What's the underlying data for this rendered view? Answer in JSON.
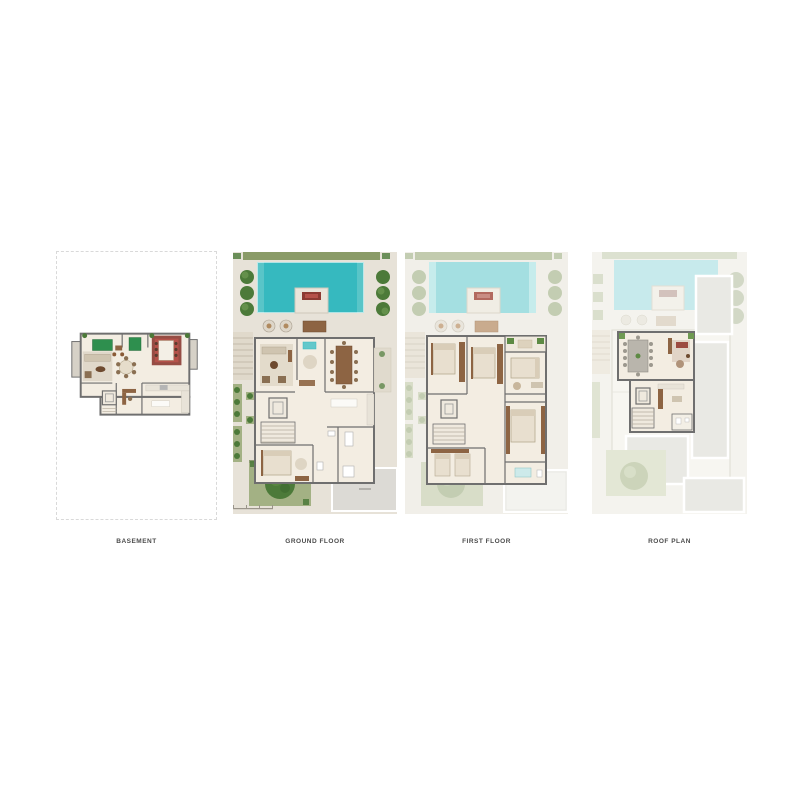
{
  "page": {
    "background": "#ffffff"
  },
  "colors": {
    "page_bg": "#ffffff",
    "label_text": "#4b4b4b",
    "dashed_border": "#d9d9d9",
    "deck": "#e7e2d8",
    "deck_faded": "#f1efe9",
    "deck_roof": "#f4f3ee",
    "wall": "#6f6f6f",
    "floor": "#f3ede2",
    "pool": "#36b9bf",
    "pool_faded": "#a4dfe1",
    "pool_roof": "#c7eaec",
    "hedge": "#8a9b68",
    "hedge_faded": "#c2cbae",
    "tree": "#4c7a39",
    "tree_faded": "#c3cdb2",
    "tree_roof": "#d2d8c6",
    "lawn": "#a3b184",
    "lawn_faded": "#d8ddc8",
    "wood": "#8d6443",
    "slab": "#dcdad5",
    "roof_slab": "#e9e9e4",
    "billiard_green": "#2e8f4e",
    "rug_red": "#8c3b33"
  },
  "plans": [
    {
      "id": "basement",
      "label": "BASEMENT"
    },
    {
      "id": "ground-floor",
      "label": "GROUND FLOOR"
    },
    {
      "id": "first-floor",
      "label": "FIRST FLOOR"
    },
    {
      "id": "roof-plan",
      "label": "ROOF PLAN"
    }
  ]
}
